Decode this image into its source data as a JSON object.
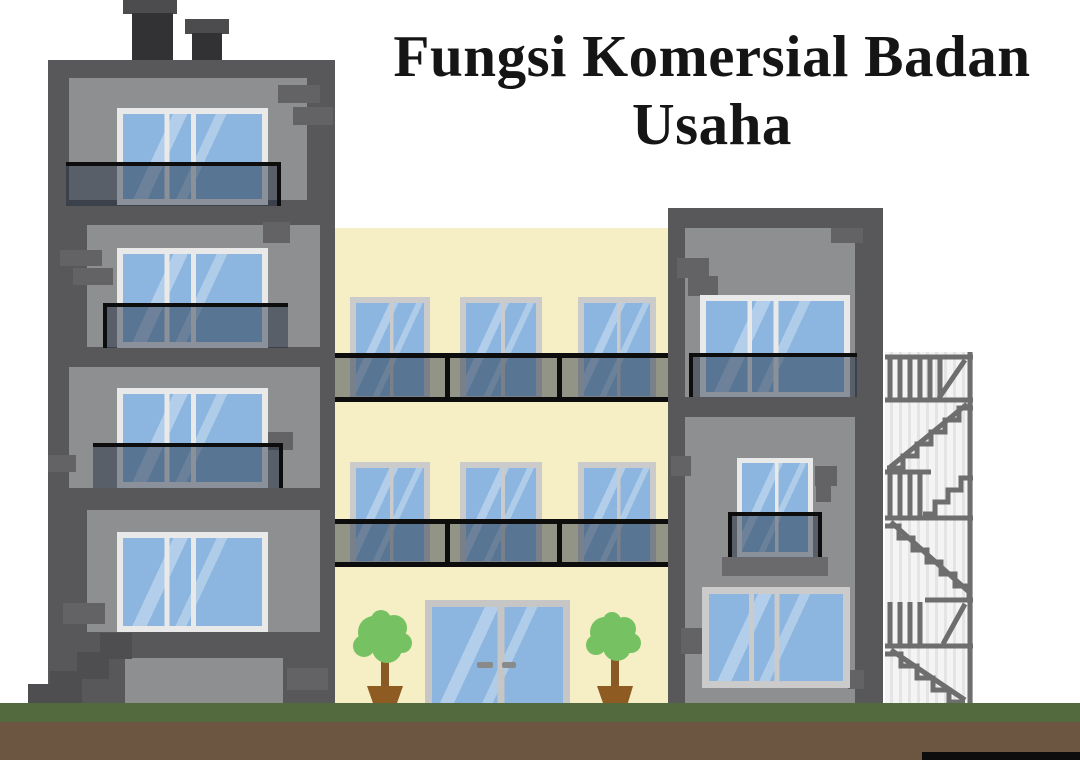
{
  "title": {
    "line1": "Fungsi Komersial Badan",
    "line2": "Usaha"
  },
  "scene": {
    "description": "Flat vector illustration of three adjoining buildings on a green and brown ground strip",
    "left_building": {
      "type": "gray apartment tower",
      "chimneys": 2,
      "window_rows": 4,
      "glass_balconies": 3,
      "external_steps": true
    },
    "middle_building": {
      "type": "yellow commercial block",
      "window_rows": 2,
      "windows_per_row": 3,
      "balcony_bands": 2,
      "glass_double_door": true,
      "potted_trees": 2
    },
    "right_building": {
      "type": "gray tower with fire escape",
      "window_rows": 3,
      "glass_balconies": 1,
      "juliet_balcony": true,
      "fire_escape": true
    }
  },
  "colors": {
    "background": "#ffffff",
    "title_text": "#151515",
    "wall_dark": "#58585a",
    "wall_mid": "#8e8f90",
    "wall_yellow": "#f6eec5",
    "brick": "#636365",
    "chimney": "#323234",
    "window_frame_light": "#e9e9e9",
    "window_frame_gray": "#cbcbcb",
    "door_frame": "#c6c6c6",
    "glass_blue": "#8cb6df",
    "balcony_tint": "rgba(24,38,58,0.45)",
    "balcony_line": "#0d0d0d",
    "fire_escape_line": "#6e6e6e",
    "fire_escape_bg": "#f4f4f4",
    "ground_green": "#53693e",
    "ground_brown": "#6d5641",
    "tree_green": "#76c263",
    "trunk_brown": "#8a5a26",
    "pot_brown": "#8e5c22",
    "footer_bar": "#0d0d0d"
  }
}
